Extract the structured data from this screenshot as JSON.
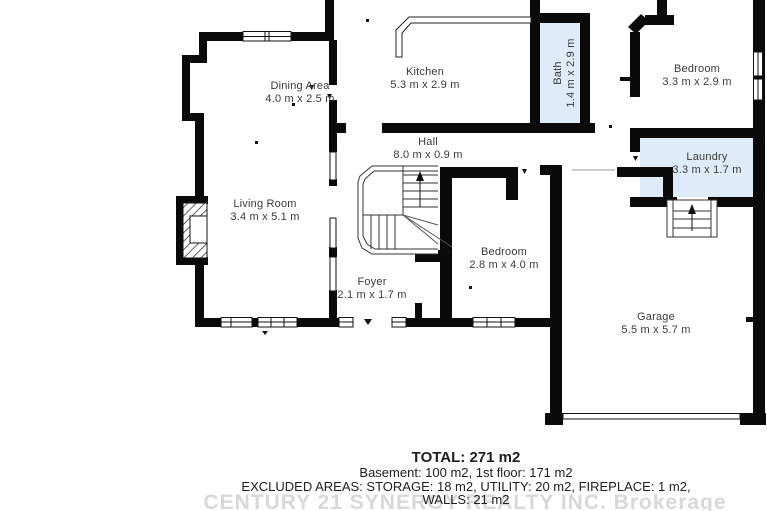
{
  "canvas": {
    "width": 767,
    "height": 511,
    "background": "#ffffff"
  },
  "colors": {
    "wall": "#0a0a0a",
    "room_fill": "#ffffff",
    "wet_room_fill": "#ddecf8",
    "label_text": "#3a3a3a",
    "summary_text": "#1e1e1e",
    "watermark_text": "#d8d8d8"
  },
  "rooms": [
    {
      "id": "dining",
      "name": "Dining Area",
      "dims": "4.0 m x 2.5 m"
    },
    {
      "id": "kitchen",
      "name": "Kitchen",
      "dims": "5.3 m x 2.9 m"
    },
    {
      "id": "bath",
      "name": "Bath",
      "dims": "1.4 m x 2.9 m"
    },
    {
      "id": "bedroom-top",
      "name": "Bedroom",
      "dims": "3.3 m x 2.9 m"
    },
    {
      "id": "hall",
      "name": "Hall",
      "dims": "8.0 m x 0.9 m"
    },
    {
      "id": "laundry",
      "name": "Laundry",
      "dims": "3.3 m x 1.7 m"
    },
    {
      "id": "living",
      "name": "Living Room",
      "dims": "3.4 m x 5.1 m"
    },
    {
      "id": "bedroom-mid",
      "name": "Bedroom",
      "dims": "2.8 m x 4.0 m"
    },
    {
      "id": "foyer",
      "name": "Foyer",
      "dims": "2.1 m x 1.7 m"
    },
    {
      "id": "garage",
      "name": "Garage",
      "dims": "5.5 m x 5.7 m"
    }
  ],
  "summary": {
    "total": "TOTAL: 271 m2",
    "floors": "Basement: 100 m2, 1st floor: 171 m2",
    "excluded": "EXCLUDED AREAS: STORAGE: 18 m2, UTILITY: 20 m2, FIREPLACE: 1 m2,",
    "walls": "WALLS: 21 m2"
  },
  "watermark": "CENTURY 21 SYNERGY REALTY INC. Brokerage"
}
